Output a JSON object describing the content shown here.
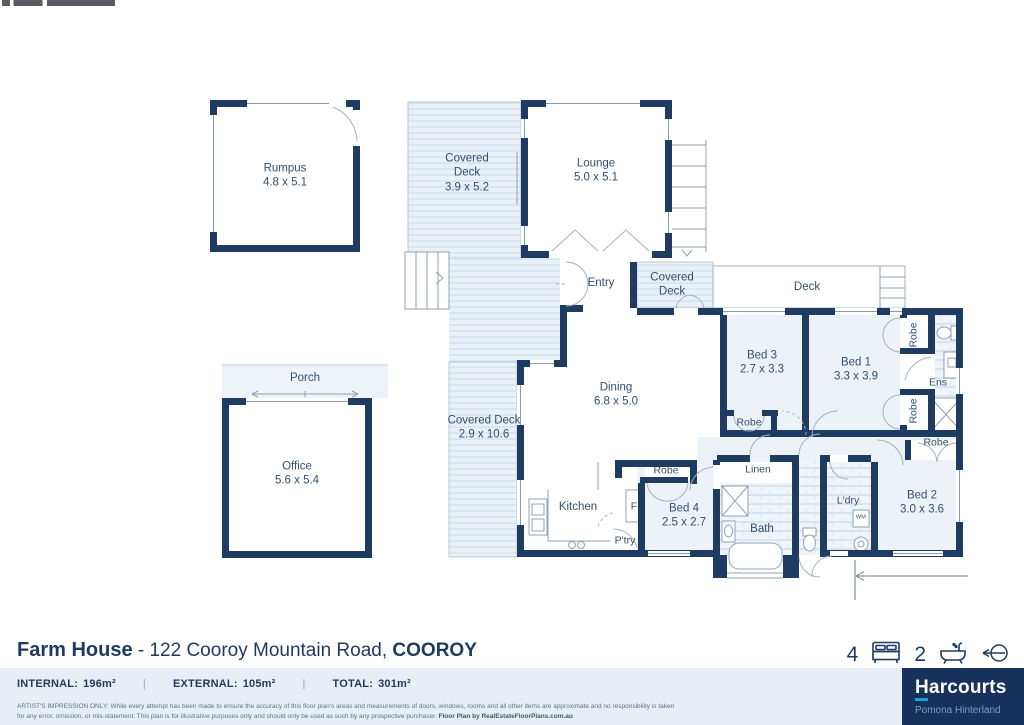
{
  "plan": {
    "rumpus": {
      "name": "Rumpus",
      "dims": "4.8 x 5.1"
    },
    "covered_deck_upper": {
      "name": "Covered Deck",
      "dims": "3.9 x 5.2"
    },
    "lounge": {
      "name": "Lounge",
      "dims": "5.0 x 5.1"
    },
    "entry": {
      "name": "Entry"
    },
    "covered_deck_entry": {
      "name": "Covered Deck"
    },
    "deck": {
      "name": "Deck"
    },
    "bed3": {
      "name": "Bed 3",
      "dims": "2.7 x 3.3"
    },
    "bed1": {
      "name": "Bed 1",
      "dims": "3.3 x 3.9"
    },
    "ensuite": {
      "name": "Ens"
    },
    "robe": {
      "name": "Robe"
    },
    "dining": {
      "name": "Dining",
      "dims": "6.8 x 5.0"
    },
    "covered_deck_side": {
      "name": "Covered Deck",
      "dims": "2.9 x 10.6"
    },
    "kitchen": {
      "name": "Kitchen"
    },
    "fridge": {
      "name": "F"
    },
    "pantry": {
      "name": "P'try"
    },
    "bed4": {
      "name": "Bed 4",
      "dims": "2.5 x 2.7"
    },
    "linen": {
      "name": "Linen"
    },
    "bath": {
      "name": "Bath"
    },
    "laundry": {
      "name": "L'dry"
    },
    "washing_machine": {
      "name": "WM"
    },
    "bed2": {
      "name": "Bed 2",
      "dims": "3.0 x 3.6"
    },
    "porch": {
      "name": "Porch"
    },
    "office": {
      "name": "Office",
      "dims": "5.6 x 5.4"
    }
  },
  "footer": {
    "property_name": "Farm House",
    "separator": "-",
    "address": "122 Cooroy Mountain Road,",
    "suburb": "COOROY",
    "beds": "4",
    "baths": "2",
    "stats": [
      {
        "label": "INTERNAL:",
        "value": "196m²"
      },
      {
        "label": "EXTERNAL:",
        "value": "105m²"
      },
      {
        "label": "TOTAL:",
        "value": "301m²"
      }
    ],
    "stat_separator": "|",
    "disclaimer_line1": "ARTIST'S IMPRESSION ONLY: While every attempt has been made to ensure the accuracy of this floor plan's areas and measurements of doors, windows, rooms and all other items are approximate and no responsibility is taken",
    "disclaimer_line2": "for any error, omission, or mis-statement. This plan is for illustrative purposes only and should only be used as such by any prospective purchaser.",
    "disclaimer_credit": "Floor Plan by RealEstateFloorPlans.com.au",
    "brand": {
      "name": "Harcourts",
      "office": "Pomona Hinterland"
    }
  },
  "colors": {
    "wall_navy": "#1e3c61",
    "brand_navy": "#16315a",
    "accent_blue": "#1ba2dc",
    "deck_blue": "#e9f0f7",
    "strip_blue": "#e8eef5"
  }
}
